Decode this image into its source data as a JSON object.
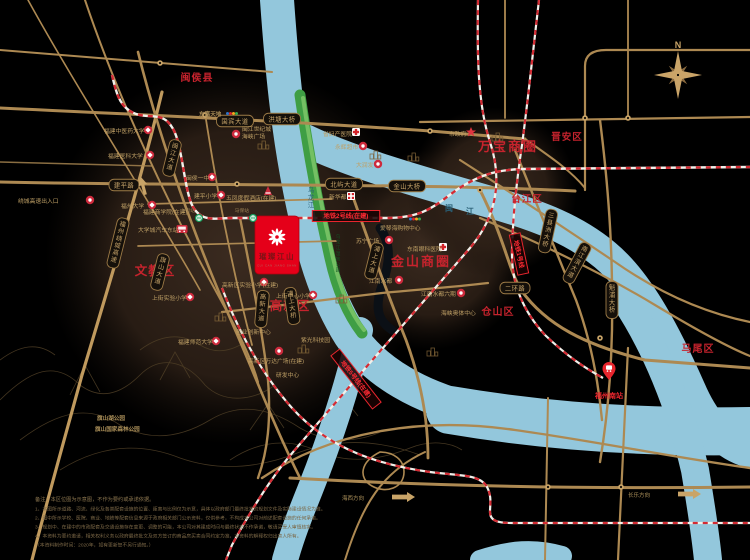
{
  "compass": {
    "label": "N"
  },
  "project": {
    "name": "璀璨江山",
    "pinyin": "CUI CAN JIANG SHAN",
    "accent": "#e50019"
  },
  "colors": {
    "road": "#ad8952",
    "river": "#93c7dc",
    "metro_red": "#d42b33",
    "park_green": "#3f9e44",
    "label_red": "#c6232d",
    "pill_gold": "#c9a66b"
  },
  "districts": [
    {
      "t": "闽侯县",
      "x": 197,
      "y": 81,
      "s": 10
    },
    {
      "t": "文教区",
      "x": 155,
      "y": 275,
      "s": 12.5
    },
    {
      "t": "高新区",
      "x": 290,
      "y": 310,
      "s": 12.5
    },
    {
      "t": "万宝商圈",
      "x": 508,
      "y": 151,
      "s": 13,
      "ls": 2
    },
    {
      "t": "金山商圈",
      "x": 421,
      "y": 266,
      "s": 13,
      "ls": 2
    },
    {
      "t": "晋安区",
      "x": 567,
      "y": 140,
      "s": 9.5
    },
    {
      "t": "台江区",
      "x": 527,
      "y": 202,
      "s": 9.5
    },
    {
      "t": "仓山区",
      "x": 498,
      "y": 315,
      "s": 10
    },
    {
      "t": "马尾区",
      "x": 698,
      "y": 352,
      "s": 10
    }
  ],
  "road_pills": [
    {
      "t": "国宾大道",
      "x": 235,
      "y": 121
    },
    {
      "t": "洪塘大桥",
      "x": 282,
      "y": 119
    },
    {
      "t": "建平路",
      "x": 124,
      "y": 185
    },
    {
      "t": "北屿大道",
      "x": 344,
      "y": 184
    },
    {
      "t": "金山大桥",
      "x": 407,
      "y": 186
    },
    {
      "t": "二环路",
      "x": 515,
      "y": 288
    },
    {
      "t": "闽江大道",
      "x": 172,
      "y": 158,
      "v": 1,
      "rot": 14
    },
    {
      "t": "福州绕城高速",
      "x": 118,
      "y": 243,
      "v": 1,
      "rot": 14
    },
    {
      "t": "旗山大道",
      "x": 160,
      "y": 272,
      "v": 1,
      "rot": 14
    },
    {
      "t": "高新大道",
      "x": 262,
      "y": 309,
      "v": 1,
      "rot": 5
    },
    {
      "t": "浦上大桥",
      "x": 292,
      "y": 306,
      "v": 1,
      "rot": -8
    },
    {
      "t": "浦上大道",
      "x": 374,
      "y": 261,
      "v": 1,
      "rot": 14
    },
    {
      "t": "三县洲大桥",
      "x": 548,
      "y": 231,
      "v": 1,
      "rot": 12
    },
    {
      "t": "南江滨大道",
      "x": 577,
      "y": 263,
      "v": 1,
      "rot": 28
    },
    {
      "t": "魁浦大桥",
      "x": 612,
      "y": 300,
      "v": 1,
      "rot": 0
    }
  ],
  "metro_boxes": [
    {
      "t": "地铁2号线(在建)",
      "x": 346,
      "y": 216,
      "rot": 0
    },
    {
      "t": "地铁5号线(在建)",
      "x": 356,
      "y": 379,
      "rot": 52
    },
    {
      "t": "地铁1号线",
      "x": 519,
      "y": 254,
      "rot": 78
    }
  ],
  "stations": [
    {
      "t": "上街站",
      "x": 199,
      "y": 218
    },
    {
      "t": "马保站",
      "x": 253,
      "y": 218
    }
  ],
  "pois": [
    {
      "t": "福建中医药大学",
      "x": 104,
      "y": 133,
      "icon": "school",
      "ix": 148,
      "iy": 130
    },
    {
      "t": "福建医科大学",
      "x": 108,
      "y": 158,
      "icon": "school",
      "ix": 150,
      "iy": 155
    },
    {
      "t": "福州大学",
      "x": 121,
      "y": 208,
      "icon": "school",
      "ix": 152,
      "iy": 205
    },
    {
      "t": "闽侯一中",
      "x": 186,
      "y": 180,
      "icon": "school",
      "ix": 212,
      "iy": 177
    },
    {
      "t": "建平小学",
      "x": 194,
      "y": 198,
      "icon": "school",
      "ix": 221,
      "iy": 195
    },
    {
      "t": "大学城汽车东站",
      "x": 138,
      "y": 232,
      "icon": "bus",
      "ix": 182,
      "iy": 229
    },
    {
      "t": "绕城高速出入口",
      "x": 18,
      "y": 203,
      "icon": "shop",
      "ix": 90,
      "iy": 200
    },
    {
      "t": "福建商学院(在建)",
      "x": 143,
      "y": 214
    },
    {
      "t": "福建师范大学",
      "x": 178,
      "y": 344,
      "icon": "school",
      "ix": 216,
      "iy": 341
    },
    {
      "t": "上街实验小学",
      "x": 152,
      "y": 300,
      "icon": "school",
      "ix": 190,
      "iy": 297
    },
    {
      "t": "五凤度假酒店(在建)",
      "x": 226,
      "y": 200,
      "icon": "build",
      "ix": 268,
      "iy": 191
    },
    {
      "t": "高新区实验小学(在建)",
      "x": 222,
      "y": 287,
      "icon": "school",
      "ix": 264,
      "iy": 282
    },
    {
      "t": "上街中心小学",
      "x": 276,
      "y": 298,
      "icon": "school",
      "ix": 313,
      "iy": 295
    },
    {
      "t": "创业创新中心",
      "x": 236,
      "y": 334
    },
    {
      "t": "高新区万达广场(在建)",
      "x": 248,
      "y": 363,
      "icon": "shop",
      "ix": 279,
      "iy": 351
    },
    {
      "t": "研发中心",
      "x": 276,
      "y": 377
    },
    {
      "t": "紫光科技园",
      "x": 301,
      "y": 342
    },
    {
      "t": "省妇产医院",
      "x": 323,
      "y": 136,
      "icon": "hospital",
      "ix": 356,
      "iy": 132
    },
    {
      "t": "永辉超市",
      "x": 335,
      "y": 149,
      "icon": "shop",
      "ix": 363,
      "iy": 146
    },
    {
      "t": "大润发",
      "x": 356,
      "y": 167,
      "icon": "shop",
      "ix": 378,
      "iy": 164
    },
    {
      "t": "新华都",
      "x": 329,
      "y": 199,
      "icon": "grid",
      "ix": 351,
      "iy": 196
    },
    {
      "t": "市政府",
      "x": 449,
      "y": 136,
      "icon": "star",
      "ix": 471,
      "iy": 132
    },
    {
      "t": "爱琴海购物中心",
      "x": 380,
      "y": 230,
      "icon": "dots",
      "ix": 415,
      "iy": 219
    },
    {
      "t": "苏宁广场",
      "x": 356,
      "y": 243,
      "icon": "shop",
      "ix": 389,
      "iy": 240
    },
    {
      "t": "东南眼科医院",
      "x": 407,
      "y": 251,
      "icon": "hospital",
      "ix": 443,
      "iy": 247
    },
    {
      "t": "江南水都",
      "x": 369,
      "y": 283,
      "icon": "shop",
      "ix": 399,
      "iy": 280
    },
    {
      "t": "江南水都六期",
      "x": 421,
      "y": 296,
      "icon": "shop",
      "ix": 461,
      "iy": 293
    },
    {
      "t": "海峡奥体中心",
      "x": 441,
      "y": 315
    },
    {
      "t": "闽江世纪城",
      "t2": "海峡广场",
      "x": 242,
      "y": 131,
      "icon": "shop",
      "ix": 236,
      "iy": 134
    }
  ],
  "gold_labels": [
    {
      "t": "旗山湖公园",
      "x": 97,
      "y": 420
    },
    {
      "t": "旗山国家森林公园",
      "x": 95,
      "y": 431
    },
    {
      "t": "东嘉天地",
      "x": 199,
      "y": 116,
      "dots": true
    }
  ],
  "river_labels": [
    {
      "t": "闽",
      "x": 449,
      "y": 211
    },
    {
      "t": "江",
      "x": 470,
      "y": 214
    }
  ],
  "vlabels": [
    {
      "t": "乌龙江",
      "x": 311,
      "y": 192,
      "s": 6.5,
      "c": "#2a6076"
    },
    {
      "t": "乌龙江湿地公园",
      "x": 338,
      "y": 238,
      "s": 4.6,
      "c": "#155226"
    }
  ],
  "arrows": {
    "up": {
      "x": 143,
      "y": 186,
      "rot": -15
    },
    "dir": [
      {
        "t": "海西方向",
        "tx": 364,
        "ty": 500,
        "ax": 392,
        "ay": 497
      },
      {
        "t": "长乐方向",
        "tx": 650,
        "ty": 497,
        "ax": 678,
        "ay": 494
      }
    ]
  },
  "south_station": {
    "t": "福州南站",
    "px": 609,
    "py": 372,
    "tx": 609,
    "ty": 398
  },
  "notes": {
    "title": "备注：本区位图为示意图，不作为要约或承诺依据。",
    "lines": [
      "1、本图所示道路、河流、绿化及各类配套设施的位置、距离与比例仅为示意，具体以政府部门最终批准的规划文件及实际建设情况为准。",
      "2、图中所示学校、医院、商业、地铁等配套信息来源于政府相关部门公示资料，仅供参考，不构成本公司对前述配套设施的任何承诺。",
      "3、规划中、在建中的市政配套及交通设施存在变更、调整的可能，本公司对其建成时间与最终状态不作承诺，敬请买受人审慎核实。",
      "4、本资料为要约邀请，相关权利义务以政府最终批文及双方签订的商品房买卖合同约定为准，本资料的解释权归出卖人所有。",
      "（本资料制作时间：2020年，如有更新恕不另行通知。）"
    ]
  }
}
